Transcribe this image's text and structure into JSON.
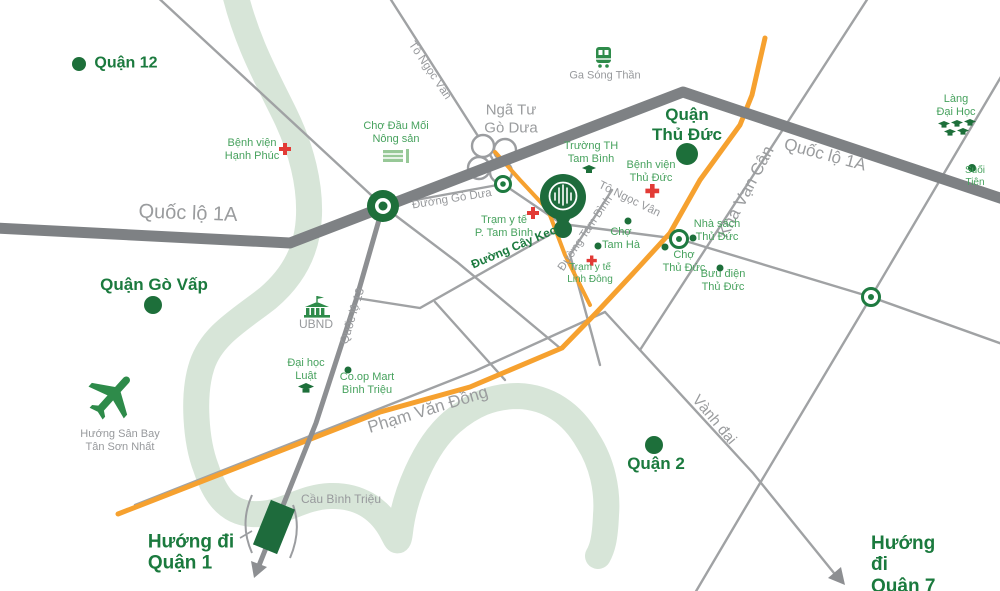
{
  "title": "Sơ đồ vị trí - bản đồ khu vực Thủ Đức",
  "colors": {
    "district_green": "#1b7a3e",
    "poi_green": "#47a25e",
    "dot_green": "#1d6f3a",
    "pin_green": "#1e6b3c",
    "road_gray": "#7e8184",
    "thin_road_gray": "#a0a2a4",
    "label_gray": "#97999c",
    "orange_road": "#f6a12f",
    "river_green": "#d7e5d8",
    "red_cross": "#e23b36"
  },
  "icons": {
    "pin": "map-pin-icon",
    "train": "train-station-icon",
    "plane": "airplane-icon",
    "cross": "hospital-cross-icon",
    "market": "market-stall-icon",
    "cap": "graduation-cap-icon",
    "building": "government-building-icon",
    "dot": "poi-dot-icon",
    "roundabout": "roundabout-icon",
    "bridge": "bridge-icon",
    "arrow": "direction-arrow-icon"
  },
  "labels": {
    "quan_12": "Quận 12",
    "benh_vien_hanh_phuc": "Bệnh viện\nHạnh Phúc",
    "quoc_lo_1a_left": "Quốc lộ 1A",
    "quoc_lo_1a_right": "Quốc lộ 1A",
    "quan_go_vap": "Quận Gò Vấp",
    "huong_san_bay": "Hướng Sân Bay\nTân Sơn Nhất",
    "cho_dau_moi": "Chợ Đầu Mối\nNông sản",
    "nga_tu_go_dua": "Ngã Tư\nGò Dưa",
    "to_ngoc_van_top": "Tô Ngọc Vân",
    "ga_song_than": "Ga Sóng Thần",
    "duong_go_dua": "Đường Gò Dưa",
    "truong_th_tam_binh": "Trường TH\nTam Bình",
    "quan_thu_duc": "Quận\nThủ Đức",
    "benh_vien_thu_duc": "Bệnh viện\nThủ Đức",
    "tram_y_te_tam_binh": "Trạm y tế\nP. Tam Bình",
    "duong_cay_keo": "Đường Cây Keo",
    "to_ngoc_van_mid": "Tô Ngọc Vân",
    "duong_tam_binh": "Đường Tam Bình",
    "cho_tam_ha": "Chợ\nTam Hà",
    "tram_y_te_linh_dong": "Trạm y tế\nLinh Đông",
    "kha_van_can": "Kha Vạn Cân",
    "lang_dai_hoc": "Làng\nĐại Học",
    "suoi_tien": "Suối Tiên",
    "nha_sach_thu_duc": "Nhà sách\nThủ Đức",
    "cho_thu_duc": "Chợ\nThủ Đức",
    "buu_dien_thu_duc": "Bưu điện\nThủ Đức",
    "ubnd": "UBND",
    "quoc_lo_13": "Quốc lộ 13",
    "dai_hoc_luat": "Đại học\nLuật",
    "coop_mart": "Co.op Mart\nBình Triệu",
    "pham_van_dong": "Phạm Văn Đồng",
    "quan_2": "Quận 2",
    "vanh_dai": "Vành đai",
    "cau_binh_trieu": "Cầu Bình Triệu",
    "huong_di_quan_1": "Hướng đi\nQuận 1",
    "huong_di_quan_7": "Hướng đi\nQuận 7"
  }
}
